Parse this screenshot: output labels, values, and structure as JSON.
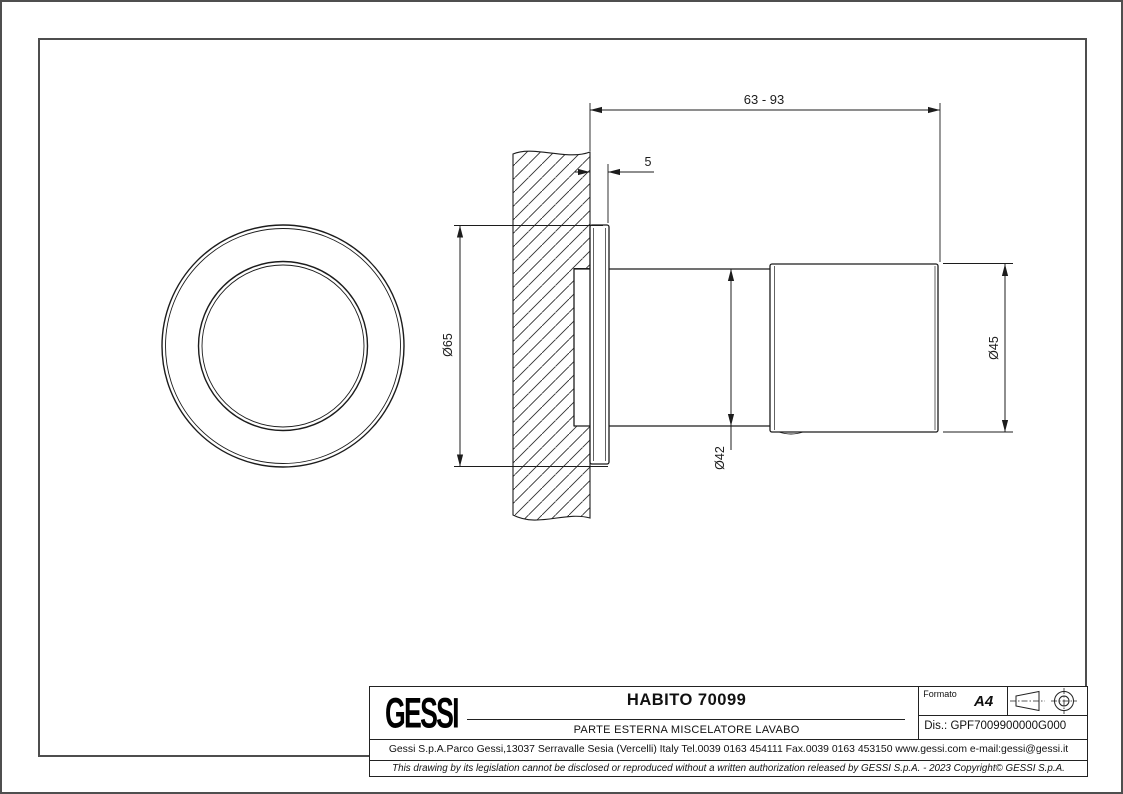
{
  "page": {
    "background": "#ffffff",
    "frame_color": "#4d4d4d",
    "line_color": "#1c1c1c"
  },
  "title_block": {
    "logo_text": "GESSI",
    "title": "HABITO 70099",
    "subtitle": "PARTE ESTERNA MISCELATORE LAVABO",
    "format_label": "Formato",
    "format_value": "A4",
    "drawing_number_label": "Dis.:",
    "drawing_number_value": "GPF7009900000G000",
    "address": "Gessi S.p.A.Parco Gessi,13037 Serravalle Sesia (Vercelli) Italy Tel.0039 0163 454111 Fax.0039 0163 453150 www.gessi.com e-mail:gessi@gessi.it",
    "legal": "This drawing by its legislation cannot be disclosed or reproduced without a written authorization released by GESSI S.p.A. - 2023 Copyright© GESSI S.p.A."
  },
  "dimensions": {
    "overall_depth": "63 - 93",
    "flange_offset": "5",
    "flange_diameter": "Ø65",
    "body_diameter": "Ø42",
    "handle_diameter": "Ø45"
  }
}
